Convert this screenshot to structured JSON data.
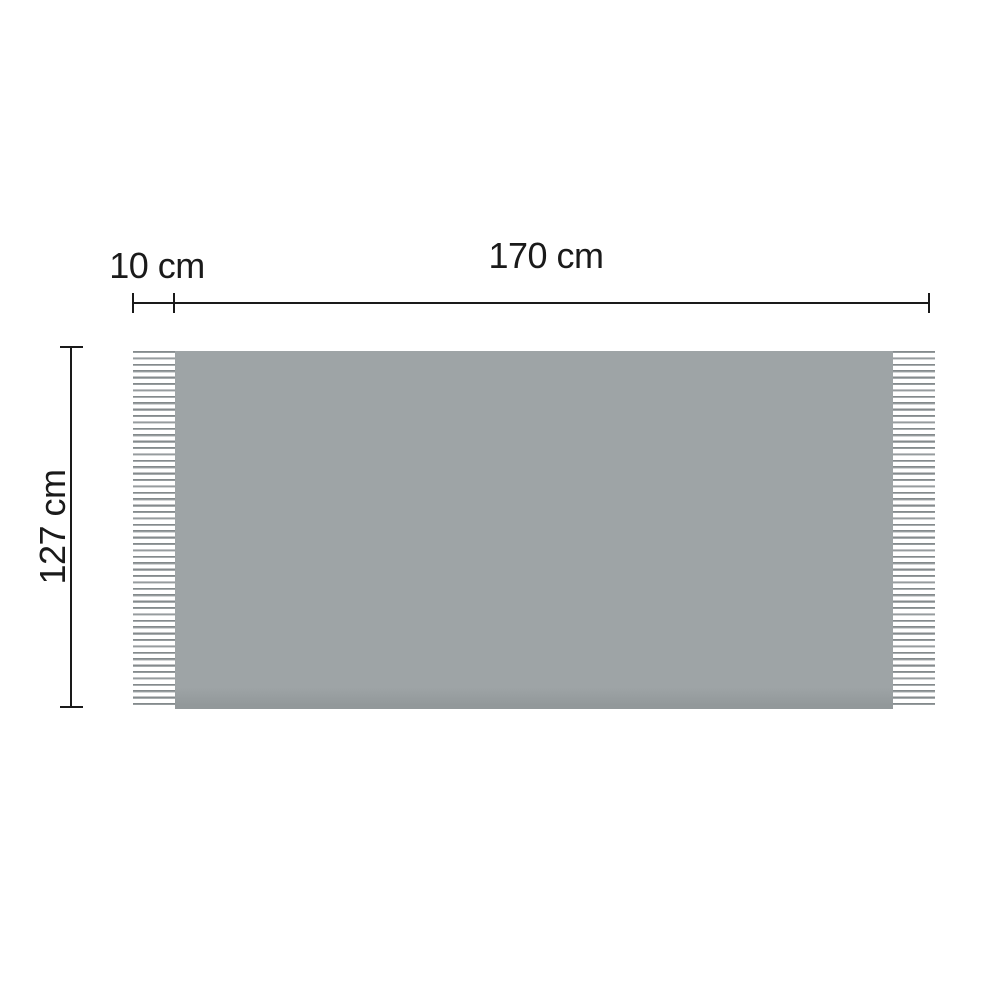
{
  "labels": {
    "fringe_width": "10 cm",
    "blanket_width": "170 cm",
    "blanket_height": "127 cm"
  },
  "values": {
    "fringe_width_cm": 10,
    "blanket_width_cm": 170,
    "blanket_height_cm": 127
  },
  "colors": {
    "background": "#ffffff",
    "text": "#1a1a1a",
    "line": "#1a1a1a",
    "blanket": "#9ea4a6",
    "blanket-shadow": "#92989a",
    "fringe-line": "#848a8c",
    "fringe-line-light": "#a8adaf"
  }
}
